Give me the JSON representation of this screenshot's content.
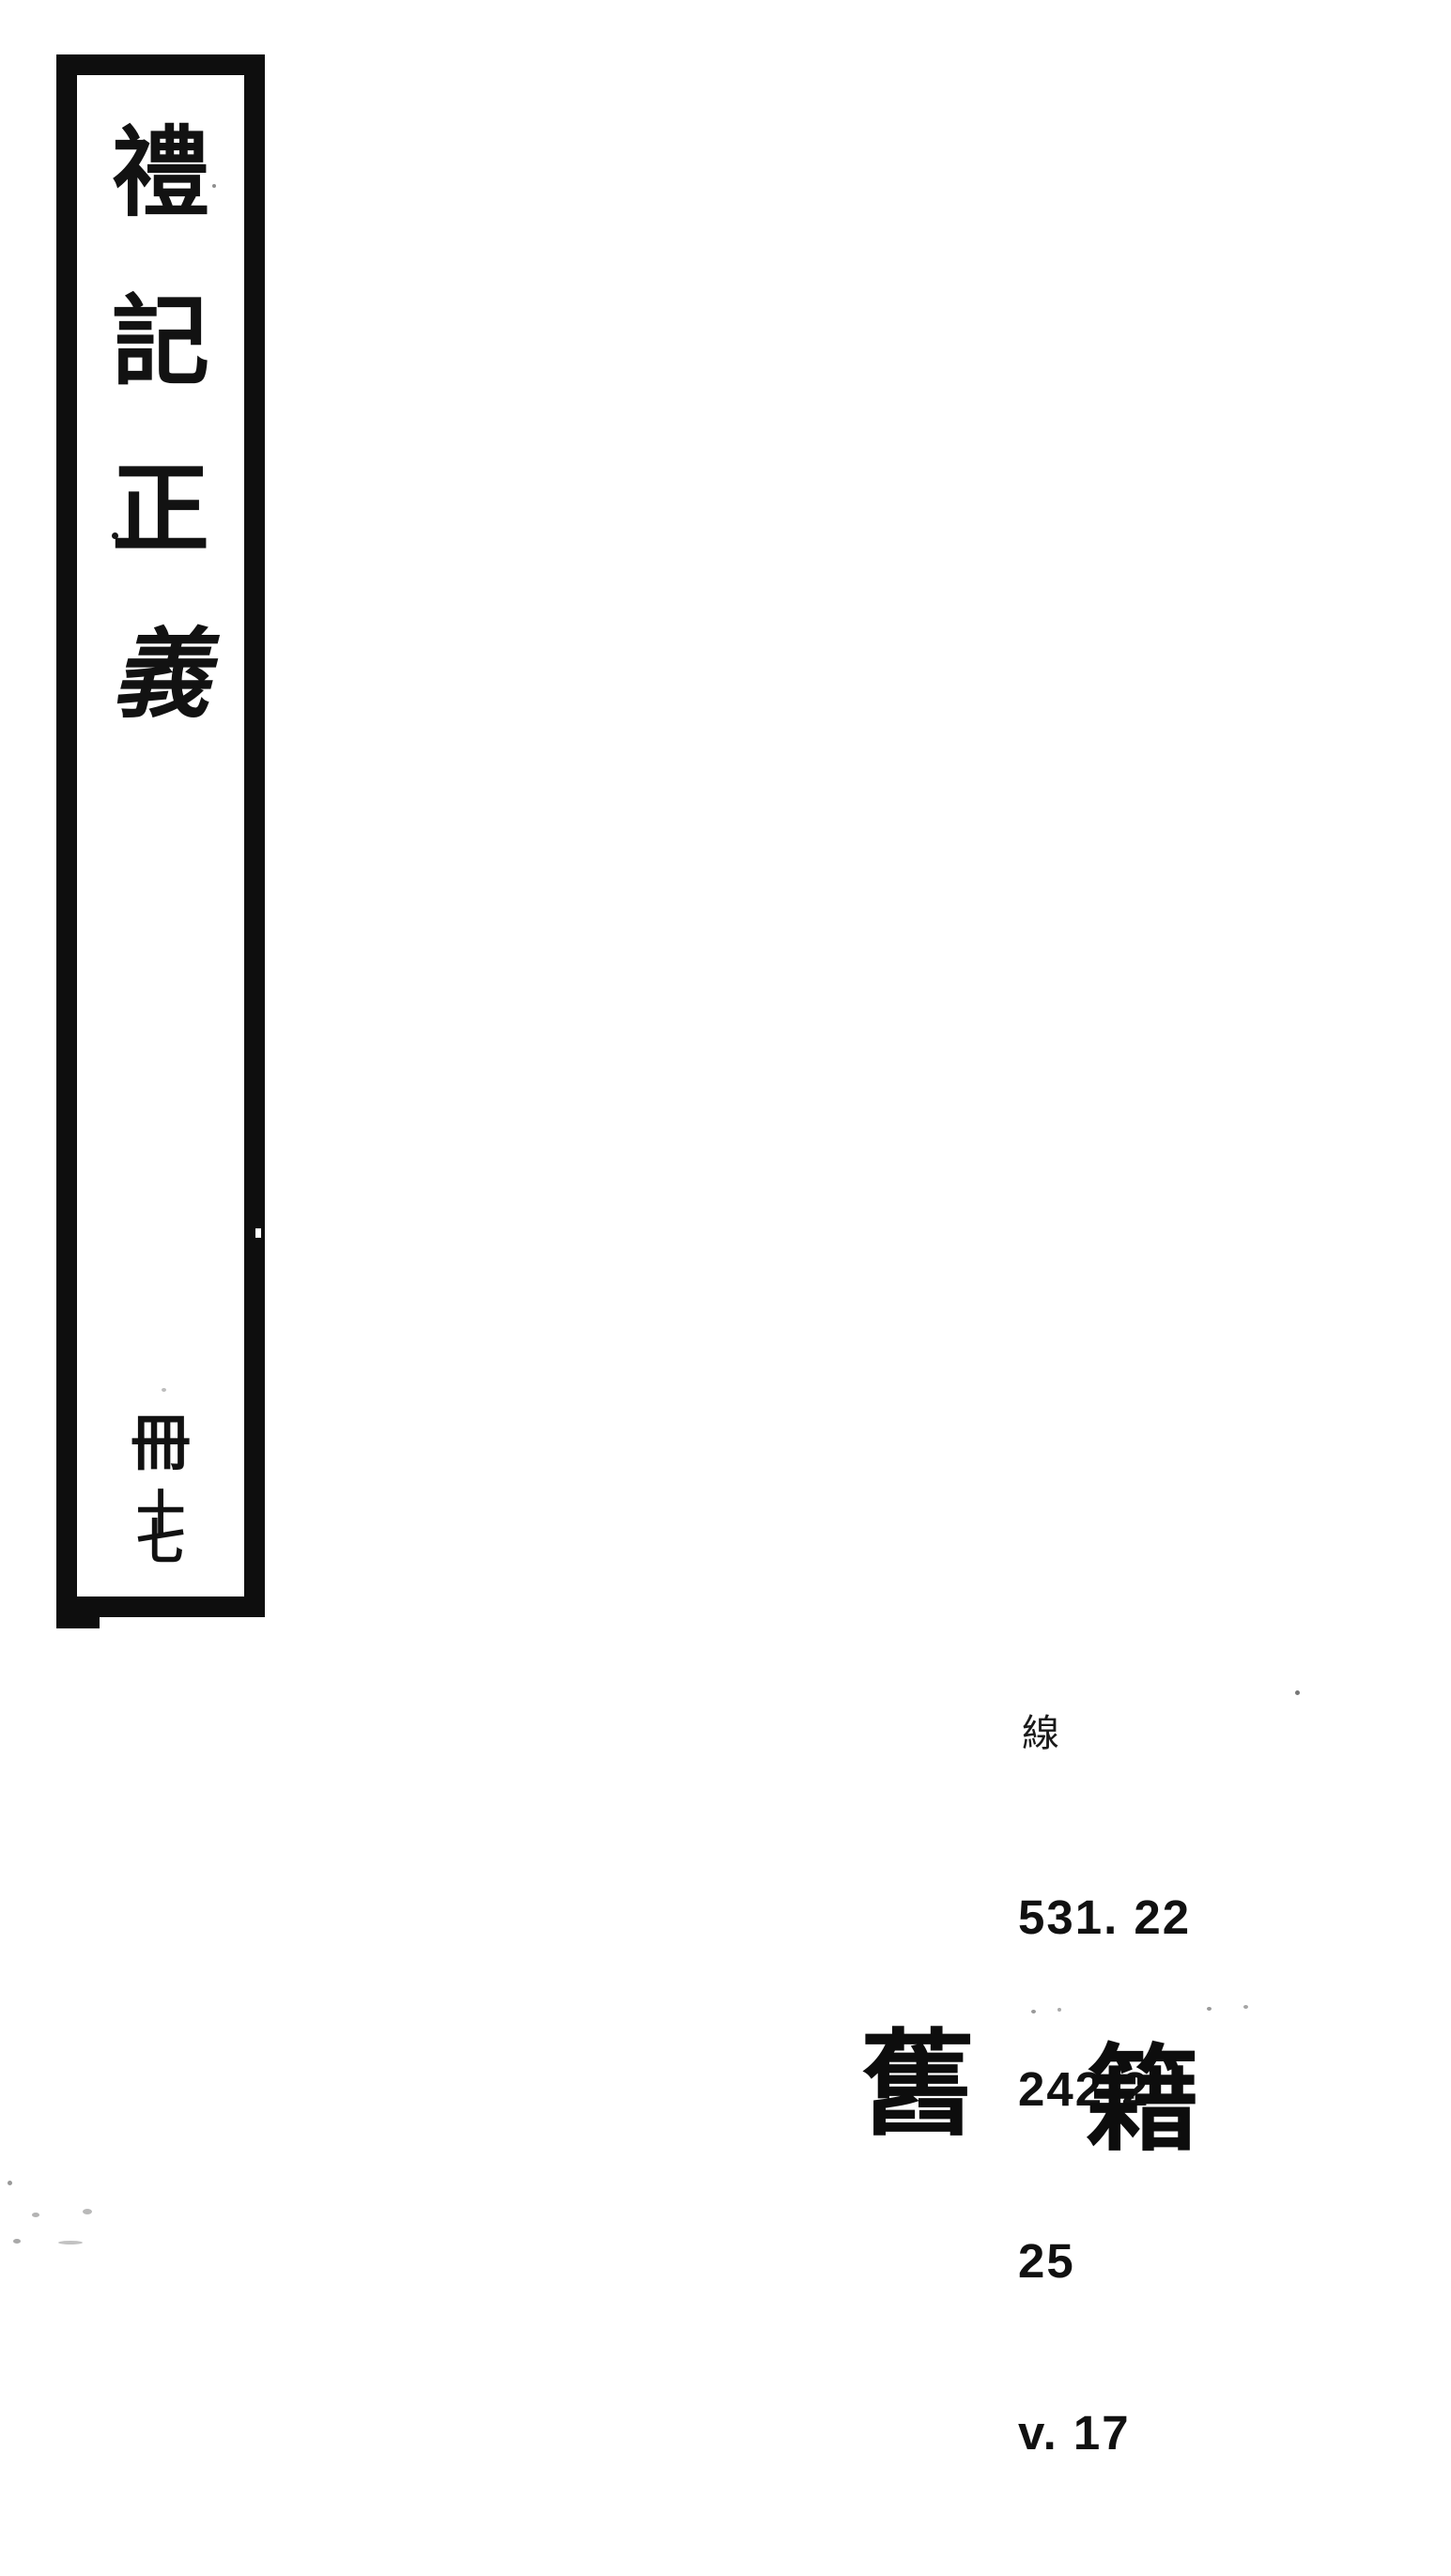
{
  "colors": {
    "background": "#ffffff",
    "ink": "#121212"
  },
  "spine": {
    "title_chars": [
      "禮",
      "記",
      "正",
      "義"
    ],
    "volume": {
      "book": "冊",
      "num_top": "十",
      "num_bottom": "七"
    }
  },
  "call_number": {
    "script_char": "線",
    "lines": [
      "531. 22",
      "242-2",
      "25",
      "v. 17"
    ]
  },
  "stamp": {
    "left_char": "舊",
    "right_char": "籍"
  }
}
